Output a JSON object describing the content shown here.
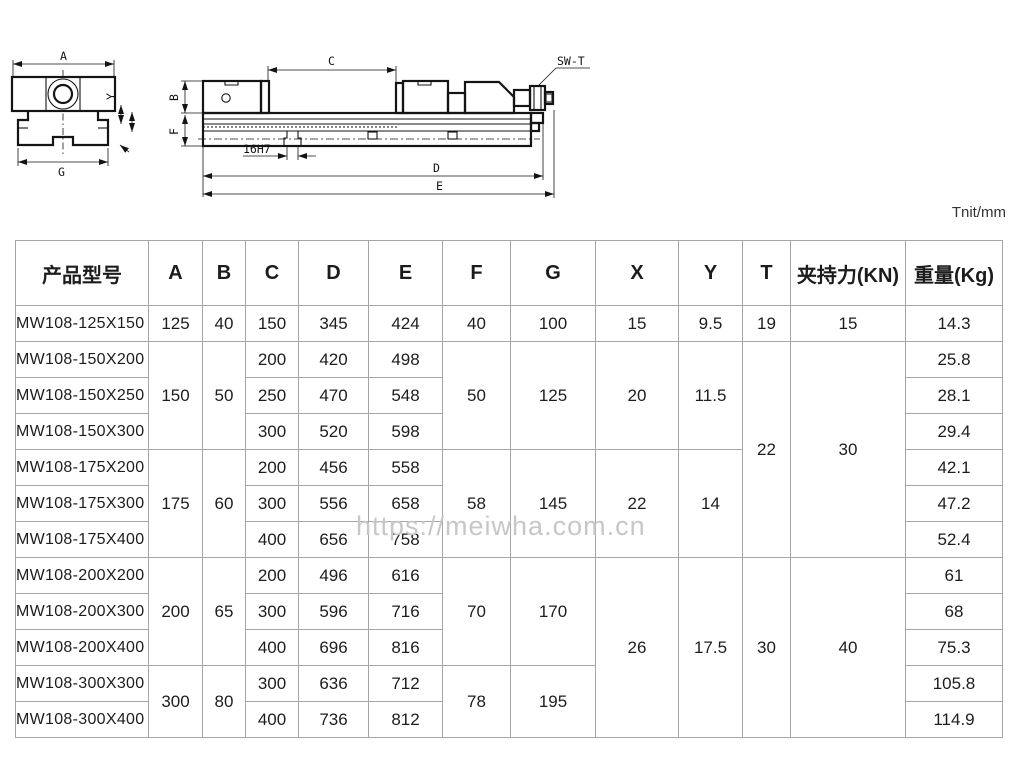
{
  "meta": {
    "unit_note": "Tnit/mm",
    "watermark": "https://meiwha.com.cn"
  },
  "drawings": {
    "front_view": {
      "dim_a": "A",
      "dim_g": "G",
      "dim_y": "Y"
    },
    "side_view": {
      "dim_c": "C",
      "dim_b": "B",
      "dim_f": "F",
      "dim_d": "D",
      "dim_e": "E",
      "keyway_label": "16H7",
      "wrench_label": "SW-T"
    }
  },
  "table": {
    "columns": [
      "产品型号",
      "A",
      "B",
      "C",
      "D",
      "E",
      "F",
      "G",
      "X",
      "Y",
      "T",
      "夹持力(KN)",
      "重量(Kg)"
    ],
    "col_widths": [
      133,
      54,
      43,
      53,
      70,
      74,
      68,
      85,
      83,
      64,
      48,
      115,
      97
    ],
    "rows": [
      [
        {
          "v": "MW108-125X150"
        },
        {
          "v": "125"
        },
        {
          "v": "40"
        },
        {
          "v": "150"
        },
        {
          "v": "345"
        },
        {
          "v": "424"
        },
        {
          "v": "40"
        },
        {
          "v": "100"
        },
        {
          "v": "15"
        },
        {
          "v": "9.5"
        },
        {
          "v": "19"
        },
        {
          "v": "15"
        },
        {
          "v": "14.3"
        }
      ],
      [
        {
          "v": "MW108-150X200"
        },
        {
          "v": "150",
          "rs": 3
        },
        {
          "v": "50",
          "rs": 3
        },
        {
          "v": "200"
        },
        {
          "v": "420"
        },
        {
          "v": "498"
        },
        {
          "v": "50",
          "rs": 3
        },
        {
          "v": "125",
          "rs": 3
        },
        {
          "v": "20",
          "rs": 3
        },
        {
          "v": "11.5",
          "rs": 3
        },
        {
          "v": "22",
          "rs": 6
        },
        {
          "v": "30",
          "rs": 6
        },
        {
          "v": "25.8"
        }
      ],
      [
        {
          "v": "MW108-150X250"
        },
        {
          "v": "250"
        },
        {
          "v": "470"
        },
        {
          "v": "548"
        },
        {
          "v": "28.1"
        }
      ],
      [
        {
          "v": "MW108-150X300"
        },
        {
          "v": "300"
        },
        {
          "v": "520"
        },
        {
          "v": "598"
        },
        {
          "v": "29.4"
        }
      ],
      [
        {
          "v": "MW108-175X200"
        },
        {
          "v": "175",
          "rs": 3
        },
        {
          "v": "60",
          "rs": 3
        },
        {
          "v": "200"
        },
        {
          "v": "456"
        },
        {
          "v": "558"
        },
        {
          "v": "58",
          "rs": 3
        },
        {
          "v": "145",
          "rs": 3
        },
        {
          "v": "22",
          "rs": 3
        },
        {
          "v": "14",
          "rs": 3
        },
        {
          "v": "42.1"
        }
      ],
      [
        {
          "v": "MW108-175X300"
        },
        {
          "v": "300"
        },
        {
          "v": "556"
        },
        {
          "v": "658"
        },
        {
          "v": "47.2"
        }
      ],
      [
        {
          "v": "MW108-175X400"
        },
        {
          "v": "400"
        },
        {
          "v": "656"
        },
        {
          "v": "758"
        },
        {
          "v": "52.4"
        }
      ],
      [
        {
          "v": "MW108-200X200"
        },
        {
          "v": "200",
          "rs": 3
        },
        {
          "v": "65",
          "rs": 3
        },
        {
          "v": "200"
        },
        {
          "v": "496"
        },
        {
          "v": "616"
        },
        {
          "v": "70",
          "rs": 3
        },
        {
          "v": "170",
          "rs": 3
        },
        {
          "v": "26",
          "rs": 5
        },
        {
          "v": "17.5",
          "rs": 5
        },
        {
          "v": "30",
          "rs": 5
        },
        {
          "v": "40",
          "rs": 5
        },
        {
          "v": "61"
        }
      ],
      [
        {
          "v": "MW108-200X300"
        },
        {
          "v": "300"
        },
        {
          "v": "596"
        },
        {
          "v": "716"
        },
        {
          "v": "68"
        }
      ],
      [
        {
          "v": "MW108-200X400"
        },
        {
          "v": "400"
        },
        {
          "v": "696"
        },
        {
          "v": "816"
        },
        {
          "v": "75.3"
        }
      ],
      [
        {
          "v": "MW108-300X300"
        },
        {
          "v": "300",
          "rs": 2
        },
        {
          "v": "80",
          "rs": 2
        },
        {
          "v": "300"
        },
        {
          "v": "636"
        },
        {
          "v": "712"
        },
        {
          "v": "78",
          "rs": 2
        },
        {
          "v": "195",
          "rs": 2
        },
        {
          "v": "105.8"
        }
      ],
      [
        {
          "v": "MW108-300X400"
        },
        {
          "v": "400"
        },
        {
          "v": "736"
        },
        {
          "v": "812"
        },
        {
          "v": "114.9"
        }
      ]
    ]
  }
}
